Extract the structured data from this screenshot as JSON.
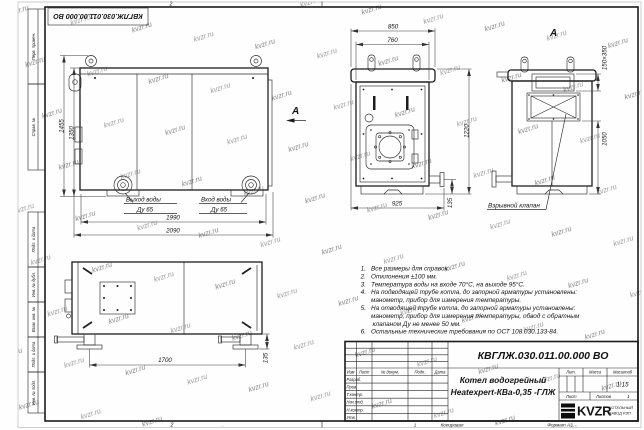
{
  "watermark": {
    "text": "kvzr.ru"
  },
  "frame": {
    "rotated_doc": "КВГЛЖ.030.011.00.000 ВО",
    "margin_labels": [
      "Перв. примен.",
      "Справ. №",
      "Подп. и дата",
      "Инв. № дубл.",
      "Взам. инв. №",
      "Подп. и дата",
      "Инв. № подл."
    ],
    "fold_mark": "2",
    "zone_mark": "1"
  },
  "views": {
    "front": {
      "view_label": "А",
      "dims": {
        "overall_height": "1455",
        "body_height": "1350",
        "inner_width": "1990",
        "overall_width": "2090"
      },
      "outlet": {
        "line1": "Выход воды",
        "line2": "Ду 65"
      },
      "inlet": {
        "line1": "Вход воды",
        "line2": "Ду 65"
      }
    },
    "side": {
      "dims": {
        "cap": "850",
        "body": "760",
        "height": "1220",
        "base": "925",
        "pipe": "135"
      }
    },
    "back": {
      "label": "А",
      "dims": {
        "flue": "150×350",
        "height": "1050"
      },
      "valve_label": "Взрывной клапан"
    },
    "top": {
      "dims": {
        "span": "1700",
        "foot": "135"
      }
    }
  },
  "notes": {
    "lines": [
      {
        "n": "1.",
        "t": "Все размеры для справок."
      },
      {
        "n": "2.",
        "t": "Отклонения ±100 мм."
      },
      {
        "n": "3.",
        "t": "Температура воды на входе 70°С, на выходе 95°С."
      },
      {
        "n": "4.",
        "t": "На подводящей трубе котла, до запорной арматуры установлены:"
      },
      {
        "n": "",
        "t": "манометр, прибор для измерения температуры."
      },
      {
        "n": "5.",
        "t": "На отводящей трубе котла, до запорной арматуры установлены:"
      },
      {
        "n": "",
        "t": "манометр, прибор для измерения температуры, обвод с обратным"
      },
      {
        "n": "",
        "t": "клапаном Ду не менее 50 мм."
      },
      {
        "n": "6.",
        "t": "Остальные технические требования по ОСТ 108.030.133-84."
      }
    ]
  },
  "titleblock": {
    "doc_number": "КВГЛЖ.030.011.00.000 ВО",
    "name_line1": "Котел водогрейный",
    "name_line2": "Heatexpert-КВа-0,35 -ГЛЖ",
    "header_cols": [
      "Изм",
      "Лист",
      "№ докум.",
      "Подп.",
      "Дата"
    ],
    "rows": [
      "Разраб.",
      "Пров.",
      "Т.контр.",
      "Нач.отд.",
      "Н.контр.",
      "Утв."
    ],
    "lit_label": "Лит.",
    "mass_label": "Масса",
    "scale_label": "Масштаб",
    "scale_value": "1:15",
    "sheet_label": "Лист",
    "sheets_label": "Листов",
    "sheets_value": "1",
    "logo_text": "KVZR",
    "company_line1": "КОТЕЛЬНЫЙ",
    "company_line2": "ЗАВОД РЭП",
    "copied_label": "Копировал",
    "format_label": "Формат А3"
  }
}
